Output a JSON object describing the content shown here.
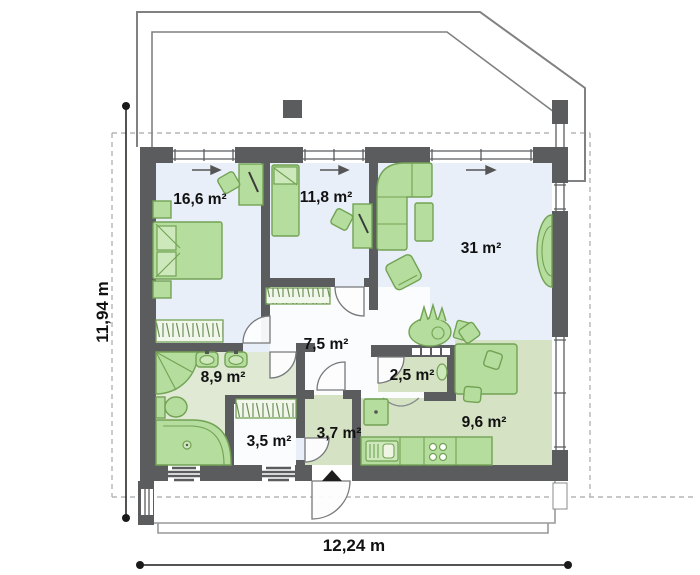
{
  "plan": {
    "type": "architectural-floor-plan",
    "rooms": [
      {
        "name": "bedroom-1",
        "area": "16,6 m²"
      },
      {
        "name": "bedroom-2",
        "area": "11,8 m²"
      },
      {
        "name": "living-room",
        "area": "31 m²"
      },
      {
        "name": "hallway",
        "area": "7,5 m²"
      },
      {
        "name": "bathroom",
        "area": "8,9 m²"
      },
      {
        "name": "pantry",
        "area": "2,5 m²"
      },
      {
        "name": "wardrobe-room",
        "area": "3,5 m²"
      },
      {
        "name": "entry",
        "area": "3,7 m²"
      },
      {
        "name": "kitchen",
        "area": "9,6 m²"
      }
    ],
    "dimensions": {
      "overall_width": "12,24 m",
      "overall_height": "11,94 m"
    },
    "colors": {
      "wall": "#5a5c5e",
      "floor_light_blue": "#e9eff8",
      "floor_green_kitchen": "#d5e3c4",
      "floor_green_bath": "#dfe9d3",
      "floor_white": "#fbfcfe",
      "furniture_fill": "#b5dd9e",
      "furniture_stroke": "#72a254",
      "outline": "#808284",
      "dimension": "#1a1a1a"
    },
    "markers": {
      "entrance_marker": "triangle-up-icon",
      "window_vent_arrows": "arrow-right-icon",
      "window_vent_arrow_count": 3
    },
    "furniture_inventory": {
      "bedroom_1": [
        "double-bed",
        "nightstand",
        "nightstand",
        "desk",
        "chair",
        "wardrobe"
      ],
      "bedroom_2": [
        "single-bed",
        "desk",
        "chair"
      ],
      "living_room": [
        "corner-sofa",
        "coffee-table",
        "armchair",
        "plant",
        "side-table"
      ],
      "hallway": [
        "wardrobe"
      ],
      "bathroom": [
        "shower",
        "washbasin",
        "washbasin",
        "toilet",
        "bathtub"
      ],
      "pantry": [
        "shelves",
        "sink"
      ],
      "wardrobe_room": [
        "wardrobe"
      ],
      "kitchen": [
        "dining-table",
        "chair",
        "chair",
        "chair",
        "plant",
        "counter",
        "sink",
        "stove",
        "fridge"
      ]
    }
  }
}
